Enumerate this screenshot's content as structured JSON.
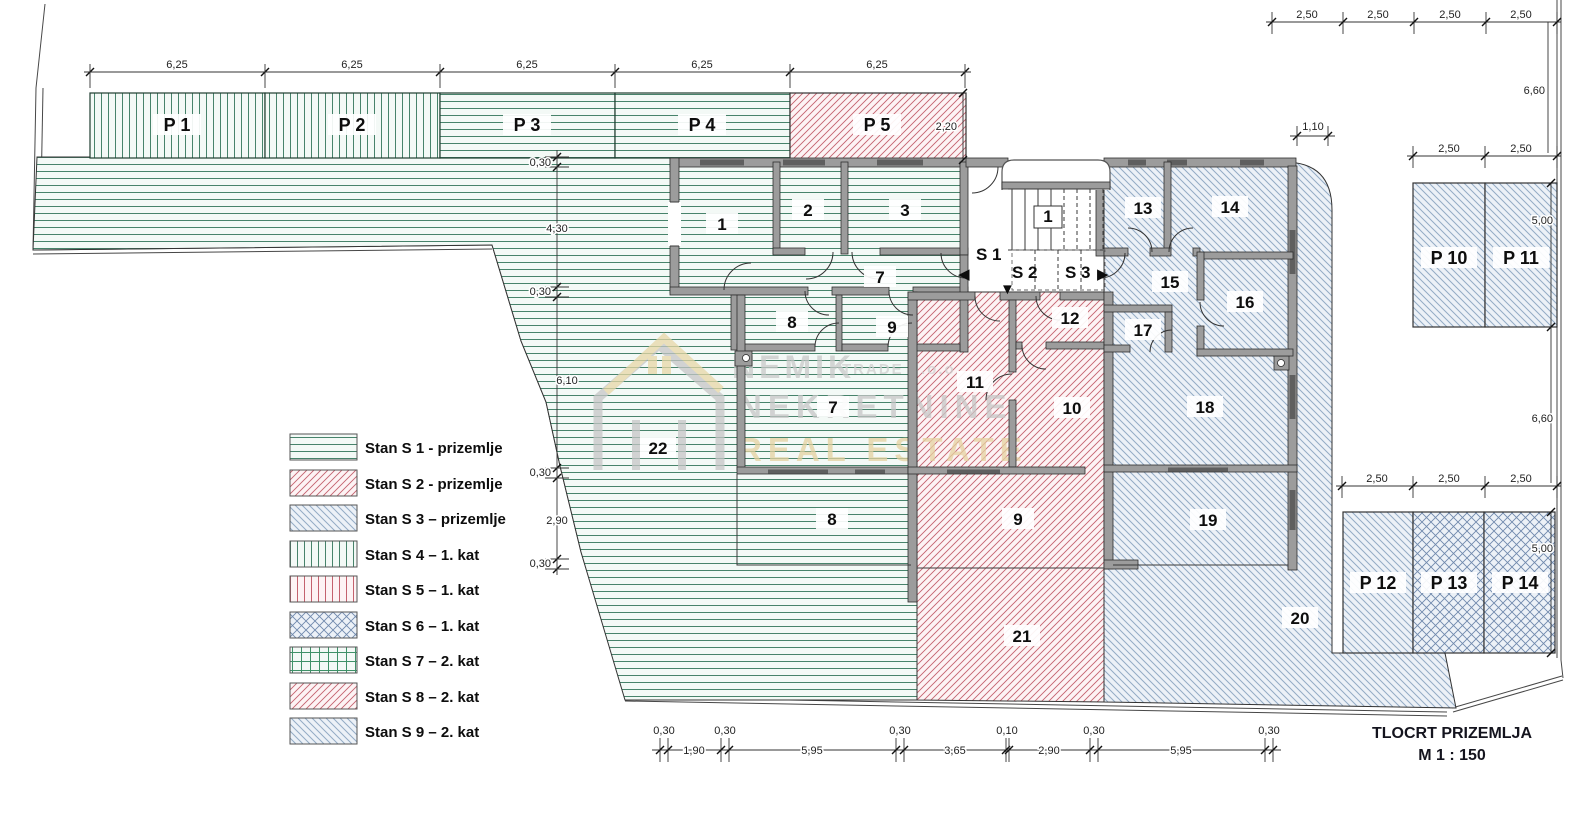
{
  "drawing": {
    "title": "TLOCRT PRIZEMLJA",
    "scale": "M 1 : 150"
  },
  "watermark": {
    "brand": "NEMIK",
    "brand_suffix": "TRADE d.o.o.",
    "line2": "NEKRETNINE",
    "line3": "REAL ESTATE"
  },
  "legend": [
    {
      "label": "Stan S 1 - prizemlje",
      "pattern": "green-horizontal"
    },
    {
      "label": "Stan S 2 - prizemlje",
      "pattern": "red-diagonal"
    },
    {
      "label": "Stan S 3 – prizemlje",
      "pattern": "blue-diagonal"
    },
    {
      "label": "Stan S 4 – 1. kat",
      "pattern": "green-vertical"
    },
    {
      "label": "Stan S 5 – 1. kat",
      "pattern": "red-vertical"
    },
    {
      "label": "Stan S 6 – 1. kat",
      "pattern": "blue-crosshatch"
    },
    {
      "label": "Stan S 7 – 2. kat",
      "pattern": "green-grid"
    },
    {
      "label": "Stan S 8 – 2. kat",
      "pattern": "red-diagonal"
    },
    {
      "label": "Stan S 9 – 2. kat",
      "pattern": "blue-diagonal"
    }
  ],
  "rooms_s1": [
    "1",
    "2",
    "3",
    "7",
    "8",
    "9",
    "7",
    "22",
    "8"
  ],
  "rooms_s2": [
    "12",
    "11",
    "10",
    "9",
    "21"
  ],
  "rooms_s3": [
    "13",
    "14",
    "15",
    "16",
    "17",
    "18",
    "19",
    "20"
  ],
  "stair_label": "1",
  "entrances": [
    "S 1",
    "S 2",
    "S 3"
  ],
  "entrance_arrows": [
    "◀",
    "▼",
    "▶"
  ],
  "parking": [
    "P 1",
    "P 2",
    "P 3",
    "P 4",
    "P 5",
    "P 10",
    "P 11",
    "P 12",
    "P 13",
    "P 14"
  ],
  "dims": {
    "top": [
      "6,25",
      "6,25",
      "6,25",
      "6,25",
      "6,25"
    ],
    "p5_height": "2,20",
    "left": [
      "0,30",
      "4,30",
      "0,30",
      "6,10",
      "0,30",
      "2,90",
      "0,30"
    ],
    "bottom": [
      "0,30",
      "1,90",
      "0,30",
      "5,95",
      "0,30",
      "3,65",
      "0,10",
      "2,90",
      "0,30",
      "5,95",
      "0,30"
    ],
    "right_top": [
      "2,50",
      "2,50",
      "2,50",
      "2,50"
    ],
    "right_height_upper": "6,60",
    "canopy_width": "1,10",
    "p10_row": [
      "2,50",
      "2,50"
    ],
    "p10_height": "5,00",
    "right_height_lower": "6,60",
    "p12_row": [
      "2,50",
      "2,50",
      "2,50"
    ],
    "p12_height": "5,00"
  },
  "colors": {
    "s1_green": "#47836b",
    "s2_red": "#c4626e",
    "s3_blue": "#93abc4",
    "wall_gray": "#9c9c9c",
    "watermark_gold": "#e5d2a0"
  }
}
